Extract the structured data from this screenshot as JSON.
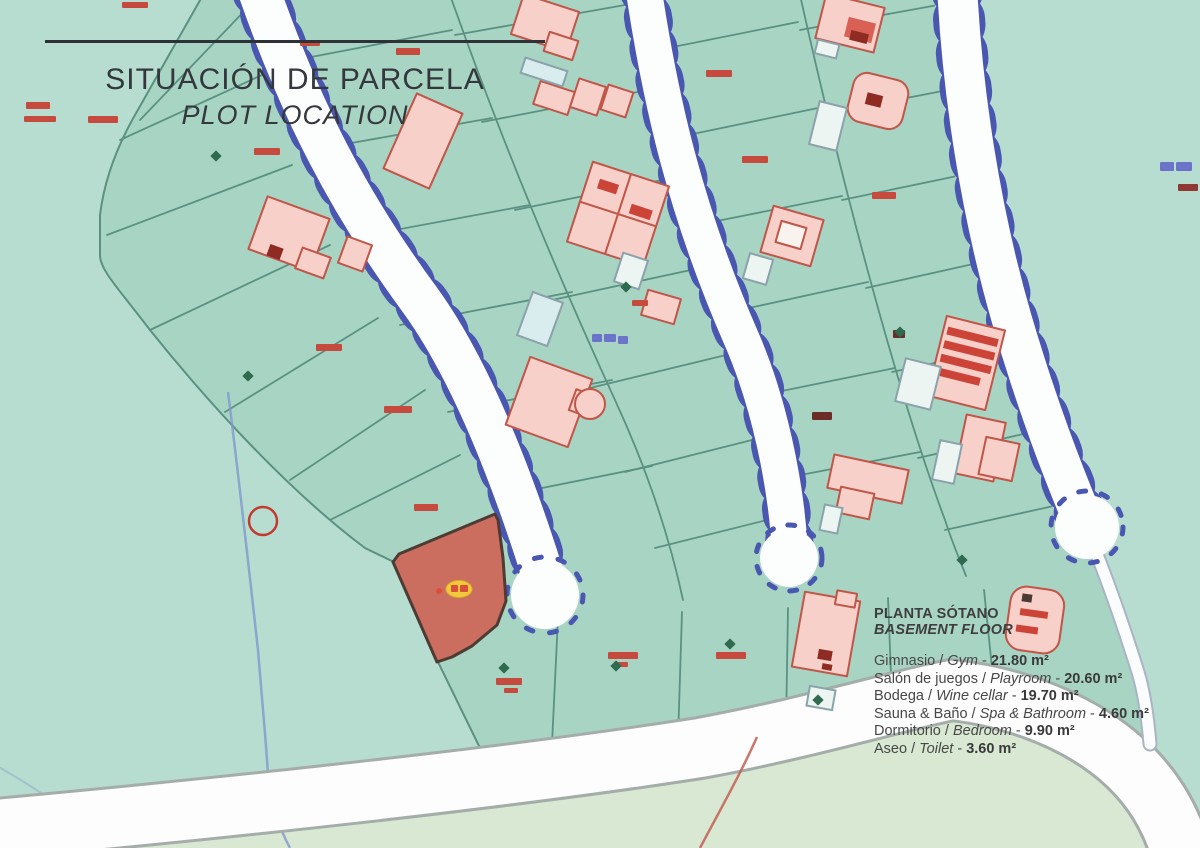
{
  "header": {
    "title": "SITUACIÓN DE PARCELA",
    "subtitle": "PLOT LOCATION"
  },
  "legend": {
    "title_primary": "PLANTA SÓTANO",
    "title_secondary": "BASEMENT FLOOR",
    "separator": " / ",
    "dash": " - ",
    "items": [
      {
        "es": "Gimnasio",
        "en": "Gym",
        "area": "21.80 m²"
      },
      {
        "es": "Salón de juegos",
        "en": "Playroom",
        "area": "20.60 m²"
      },
      {
        "es": "Bodega",
        "en": "Wine cellar",
        "area": "19.70 m²"
      },
      {
        "es": "Sauna & Baño",
        "en": "Spa & Bathroom",
        "area": "4.60 m²"
      },
      {
        "es": "Dormitorio",
        "en": "Bedroom",
        "area": "9.90 m²"
      },
      {
        "es": "Aseo",
        "en": "Toilet",
        "area": "3.60 m²"
      }
    ]
  },
  "map": {
    "colors": {
      "open_land": "#b7ddd1",
      "parcel_fill": "#a8d4c4",
      "parcel_border": "#5b9181",
      "road_fill": "#ffffff",
      "road_tick_blue": "#4a57b0",
      "building_fill": "#f6d0c9",
      "building_outline": "#c05548",
      "pool_fill": "#ecf5f2",
      "highlighted_plot_fill": "#cb6e60",
      "plot_marker_yellow": "#f2c93c",
      "plot_number_red": "#c64a3e",
      "location_circle_red": "#c23b30",
      "lower_field_green": "#d9e8d2"
    },
    "marker": {
      "type": "yellow-oval-plot-marker"
    },
    "location_circle": {
      "type": "red-outline-circle"
    }
  }
}
